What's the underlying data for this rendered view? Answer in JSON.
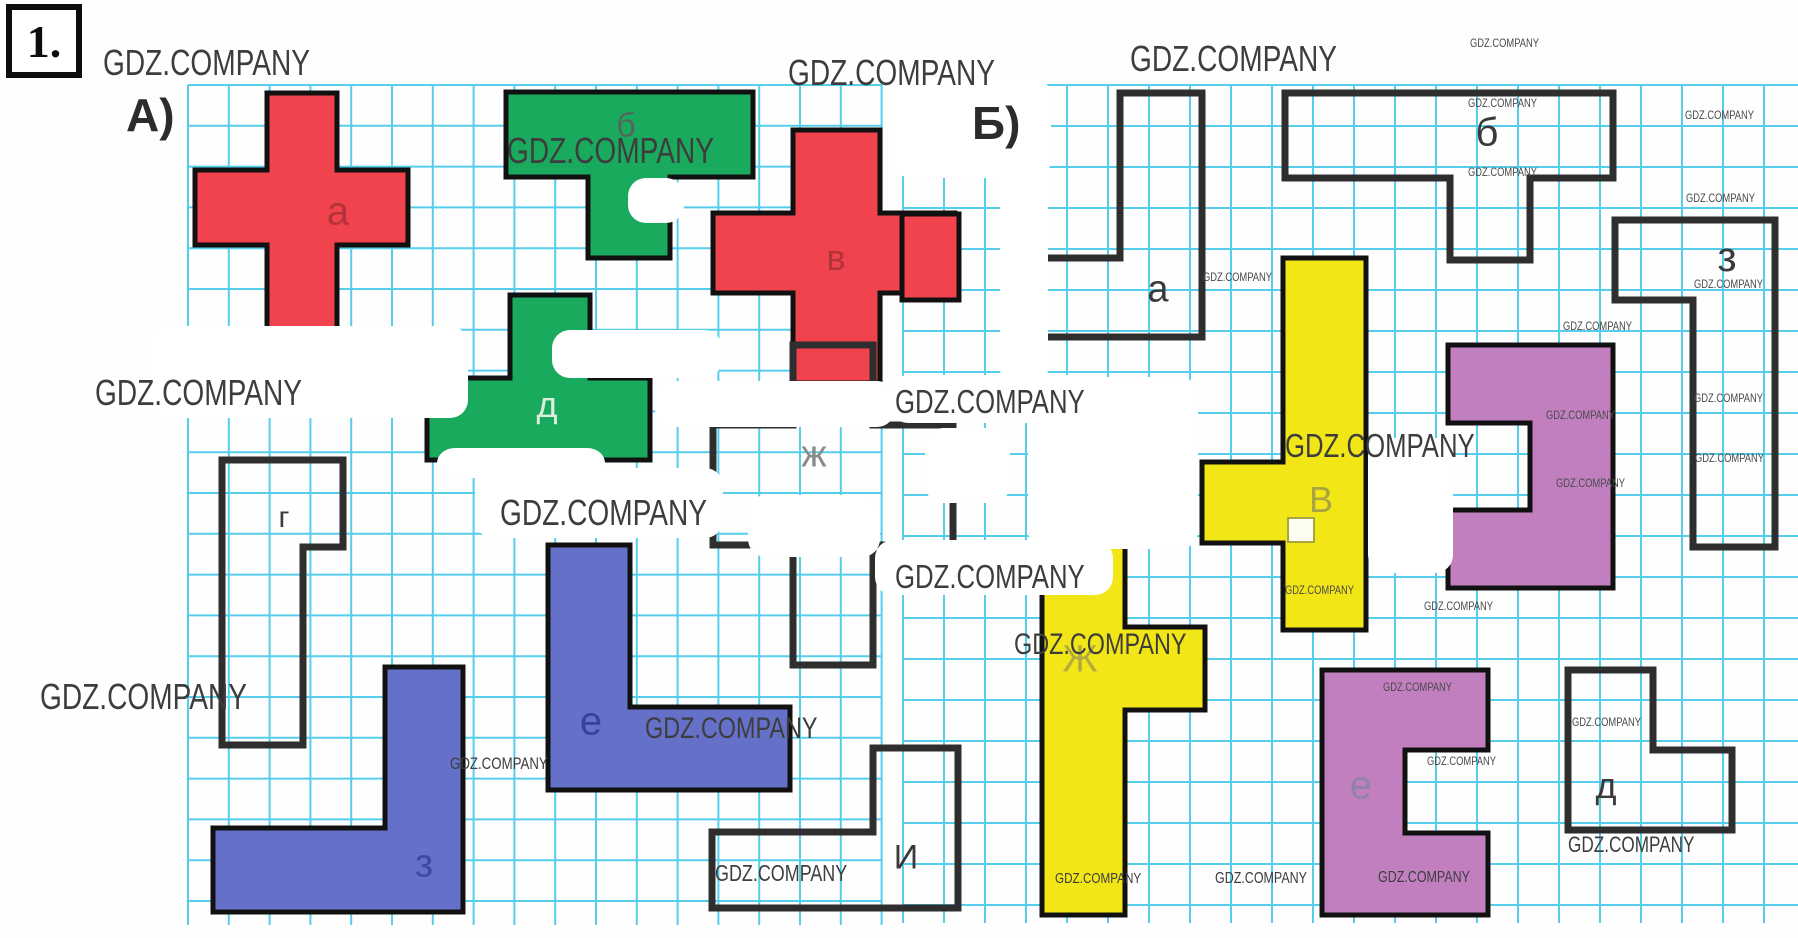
{
  "task_number": "1.",
  "watermark_text": "GDZ.COMPANY",
  "page": {
    "width": 1798,
    "height": 938,
    "background": "#fefefe"
  },
  "colors": {
    "grid": "#2cc3e8",
    "red": "#f0434e",
    "green": "#1aaa5d",
    "blue": "#6571c9",
    "yellow": "#f2e617",
    "purple": "#c27fc0",
    "outline": "#2e2e2e",
    "shape_border": "#111111"
  },
  "panels": [
    {
      "id": "A",
      "label": "А)",
      "label_x": 126,
      "label_y": 88,
      "grid": {
        "x": 188,
        "y": 85,
        "w": 694,
        "h": 840,
        "cell": 40.8
      }
    },
    {
      "id": "B",
      "label": "Б)",
      "label_x": 972,
      "label_y": 96,
      "grid": {
        "x": 903,
        "y": 85,
        "w": 895,
        "h": 838,
        "cell": 41
      }
    }
  ],
  "shapes": [
    {
      "id": "a-red-cross",
      "panel": "A",
      "fill": "#f0434e",
      "stroke": "#111111",
      "sw": 5,
      "points": [
        [
          267,
          93
        ],
        [
          337,
          93
        ],
        [
          337,
          170
        ],
        [
          408,
          170
        ],
        [
          408,
          245
        ],
        [
          337,
          245
        ],
        [
          337,
          330
        ],
        [
          267,
          330
        ],
        [
          267,
          245
        ],
        [
          195,
          245
        ],
        [
          195,
          170
        ],
        [
          267,
          170
        ]
      ],
      "label": "а",
      "lx": 338,
      "ly": 212,
      "lc": "#b3333b",
      "ls": 40
    },
    {
      "id": "b-green-tee",
      "panel": "A",
      "fill": "#1aaa5d",
      "stroke": "#111111",
      "sw": 5,
      "points": [
        [
          506,
          92
        ],
        [
          753,
          92
        ],
        [
          753,
          177
        ],
        [
          670,
          177
        ],
        [
          670,
          258
        ],
        [
          588,
          258
        ],
        [
          588,
          177
        ],
        [
          506,
          177
        ]
      ],
      "label": "б",
      "lx": 626,
      "ly": 126,
      "lc": "#51675a",
      "ls": 34
    },
    {
      "id": "v-red-cross",
      "panel": "A",
      "fill": "#f0434e",
      "stroke": "#111111",
      "sw": 5,
      "points": [
        [
          793,
          130
        ],
        [
          880,
          130
        ],
        [
          880,
          213
        ],
        [
          955,
          213
        ],
        [
          955,
          293
        ],
        [
          880,
          293
        ],
        [
          880,
          383
        ],
        [
          793,
          383
        ],
        [
          793,
          293
        ],
        [
          713,
          293
        ],
        [
          713,
          213
        ],
        [
          793,
          213
        ]
      ],
      "label": "в",
      "lx": 836,
      "ly": 258,
      "lc": "#b3333b",
      "ls": 36
    },
    {
      "id": "d-green-tee",
      "panel": "A",
      "fill": "#1aaa5d",
      "stroke": "#111111",
      "sw": 5,
      "points": [
        [
          510,
          295
        ],
        [
          590,
          295
        ],
        [
          590,
          378
        ],
        [
          650,
          378
        ],
        [
          650,
          460
        ],
        [
          427,
          460
        ],
        [
          427,
          378
        ],
        [
          510,
          378
        ]
      ],
      "label": "д",
      "lx": 547,
      "ly": 405,
      "lc": "#ddeede",
      "ls": 36
    },
    {
      "id": "g-outline",
      "panel": "A",
      "fill": "none",
      "stroke": "#2e2e2e",
      "sw": 7,
      "points": [
        [
          222,
          460
        ],
        [
          343,
          460
        ],
        [
          343,
          547
        ],
        [
          303,
          547
        ],
        [
          303,
          745
        ],
        [
          222,
          745
        ]
      ],
      "label": "г",
      "lx": 284,
      "ly": 518,
      "lc": "#3c3c3c",
      "ls": 30
    },
    {
      "id": "zh-outline",
      "panel": "A",
      "fill": "none",
      "stroke": "#2e2e2e",
      "sw": 7,
      "points": [
        [
          793,
          345
        ],
        [
          873,
          345
        ],
        [
          873,
          425
        ],
        [
          953,
          425
        ],
        [
          953,
          545
        ],
        [
          873,
          545
        ],
        [
          873,
          665
        ],
        [
          793,
          665
        ],
        [
          793,
          545
        ],
        [
          713,
          545
        ],
        [
          713,
          425
        ],
        [
          793,
          425
        ]
      ],
      "label": "ж",
      "lx": 814,
      "ly": 455,
      "lc": "#8a8a8a",
      "ls": 38
    },
    {
      "id": "e-blue-ell",
      "panel": "A",
      "fill": "#6571c9",
      "stroke": "#111111",
      "sw": 5,
      "points": [
        [
          548,
          545
        ],
        [
          630,
          545
        ],
        [
          630,
          707
        ],
        [
          790,
          707
        ],
        [
          790,
          790
        ],
        [
          548,
          790
        ]
      ],
      "label": "е",
      "lx": 591,
      "ly": 722,
      "lc": "#38429b",
      "ls": 40
    },
    {
      "id": "z-blue-ell",
      "panel": "A",
      "fill": "#6571c9",
      "stroke": "#111111",
      "sw": 5,
      "points": [
        [
          385,
          667
        ],
        [
          463,
          667
        ],
        [
          463,
          912
        ],
        [
          213,
          912
        ],
        [
          213,
          828
        ],
        [
          385,
          828
        ]
      ],
      "label": "з",
      "lx": 424,
      "ly": 864,
      "lc": "#3d4aa4",
      "ls": 40
    },
    {
      "id": "i-outline",
      "panel": "A",
      "fill": "none",
      "stroke": "#2e2e2e",
      "sw": 7,
      "points": [
        [
          712,
          832
        ],
        [
          873,
          832
        ],
        [
          873,
          748
        ],
        [
          958,
          748
        ],
        [
          958,
          908
        ],
        [
          712,
          908
        ]
      ],
      "label": "И",
      "lx": 906,
      "ly": 858,
      "lc": "#3a3a3a",
      "ls": 34
    },
    {
      "id": "red-square",
      "panel": "B",
      "fill": "#f0434e",
      "stroke": "#111111",
      "sw": 5,
      "points": [
        [
          902,
          214
        ],
        [
          959,
          214
        ],
        [
          959,
          300
        ],
        [
          902,
          300
        ]
      ],
      "label": "",
      "lx": 0,
      "ly": 0,
      "lc": "#000",
      "ls": 0
    },
    {
      "id": "a-outline-b",
      "panel": "B",
      "fill": "none",
      "stroke": "#2e2e2e",
      "sw": 7,
      "points": [
        [
          1120,
          93
        ],
        [
          1202,
          93
        ],
        [
          1202,
          337
        ],
        [
          1043,
          337
        ],
        [
          1043,
          258
        ],
        [
          1120,
          258
        ]
      ],
      "label": "а",
      "lx": 1158,
      "ly": 290,
      "lc": "#3a3a3a",
      "ls": 38
    },
    {
      "id": "b-outline-b",
      "panel": "B",
      "fill": "none",
      "stroke": "#2e2e2e",
      "sw": 7,
      "points": [
        [
          1285,
          93
        ],
        [
          1613,
          93
        ],
        [
          1613,
          178
        ],
        [
          1530,
          178
        ],
        [
          1530,
          260
        ],
        [
          1450,
          260
        ],
        [
          1450,
          178
        ],
        [
          1285,
          178
        ]
      ],
      "label": "б",
      "lx": 1487,
      "ly": 133,
      "lc": "#3a3a3a",
      "ls": 40
    },
    {
      "id": "v-yellow",
      "panel": "B",
      "fill": "#f2e617",
      "stroke": "#111111",
      "sw": 5,
      "points": [
        [
          1283,
          258
        ],
        [
          1366,
          258
        ],
        [
          1366,
          630
        ],
        [
          1283,
          630
        ],
        [
          1283,
          543
        ],
        [
          1202,
          543
        ],
        [
          1202,
          462
        ],
        [
          1283,
          462
        ]
      ],
      "label": "В",
      "lx": 1321,
      "ly": 500,
      "lc": "#a9a342",
      "ls": 36
    },
    {
      "id": "g-purple",
      "panel": "B",
      "fill": "#c27fc0",
      "stroke": "#111111",
      "sw": 5,
      "points": [
        [
          1448,
          345
        ],
        [
          1613,
          345
        ],
        [
          1613,
          588
        ],
        [
          1448,
          588
        ],
        [
          1448,
          510
        ],
        [
          1530,
          510
        ],
        [
          1530,
          423
        ],
        [
          1448,
          423
        ]
      ],
      "label": "",
      "lx": 0,
      "ly": 0,
      "lc": "#000",
      "ls": 0
    },
    {
      "id": "zh-yellow",
      "panel": "B",
      "fill": "#f2e617",
      "stroke": "#111111",
      "sw": 5,
      "points": [
        [
          1042,
          543
        ],
        [
          1125,
          543
        ],
        [
          1125,
          627
        ],
        [
          1205,
          627
        ],
        [
          1205,
          710
        ],
        [
          1125,
          710
        ],
        [
          1125,
          915
        ],
        [
          1042,
          915
        ]
      ],
      "label": "Ж",
      "lx": 1080,
      "ly": 660,
      "lc": "#b1ab3f",
      "ls": 38
    },
    {
      "id": "e-purple",
      "panel": "B",
      "fill": "#c27fc0",
      "stroke": "#111111",
      "sw": 5,
      "points": [
        [
          1322,
          670
        ],
        [
          1488,
          670
        ],
        [
          1488,
          750
        ],
        [
          1405,
          750
        ],
        [
          1405,
          833
        ],
        [
          1488,
          833
        ],
        [
          1488,
          915
        ],
        [
          1322,
          915
        ]
      ],
      "label": "е",
      "lx": 1361,
      "ly": 786,
      "lc": "#8f84a8",
      "ls": 40
    },
    {
      "id": "d-outline-b",
      "panel": "B",
      "fill": "none",
      "stroke": "#2e2e2e",
      "sw": 7,
      "points": [
        [
          1568,
          670
        ],
        [
          1653,
          670
        ],
        [
          1653,
          750
        ],
        [
          1732,
          750
        ],
        [
          1732,
          830
        ],
        [
          1568,
          830
        ]
      ],
      "label": "д",
      "lx": 1606,
      "ly": 786,
      "lc": "#3a3a3a",
      "ls": 36
    },
    {
      "id": "z-outline-b",
      "panel": "B",
      "fill": "none",
      "stroke": "#2e2e2e",
      "sw": 7,
      "points": [
        [
          1615,
          220
        ],
        [
          1775,
          220
        ],
        [
          1775,
          547
        ],
        [
          1693,
          547
        ],
        [
          1693,
          300
        ],
        [
          1615,
          300
        ]
      ],
      "label": "з",
      "lx": 1727,
      "ly": 257,
      "lc": "#3a3a3a",
      "ls": 42
    }
  ],
  "label_box": {
    "x": 1288,
    "y": 518,
    "w": 26,
    "h": 24,
    "fill": "#fdfdf2",
    "stroke": "#a7a642"
  },
  "whiteouts": [
    [
      148,
      326,
      320,
      92
    ],
    [
      552,
      330,
      170,
      48
    ],
    [
      655,
      381,
      240,
      46
    ],
    [
      748,
      495,
      132,
      62
    ],
    [
      925,
      428,
      85,
      75
    ],
    [
      890,
      375,
      225,
      48
    ],
    [
      875,
      540,
      238,
      55
    ],
    [
      1000,
      82,
      48,
      305
    ],
    [
      893,
      78,
      158,
      100
    ],
    [
      1028,
      377,
      170,
      172
    ],
    [
      475,
      468,
      248,
      70
    ],
    [
      437,
      448,
      168,
      30
    ],
    [
      628,
      178,
      56,
      45
    ],
    [
      1368,
      438,
      85,
      135
    ]
  ],
  "watermarks": [
    {
      "x": 103,
      "y": 42,
      "fs": 36
    },
    {
      "x": 788,
      "y": 52,
      "fs": 36
    },
    {
      "x": 1130,
      "y": 38,
      "fs": 36
    },
    {
      "x": 507,
      "y": 130,
      "fs": 36
    },
    {
      "x": 95,
      "y": 372,
      "fs": 36
    },
    {
      "x": 500,
      "y": 492,
      "fs": 36
    },
    {
      "x": 40,
      "y": 676,
      "fs": 36
    },
    {
      "x": 895,
      "y": 383,
      "fs": 33
    },
    {
      "x": 895,
      "y": 558,
      "fs": 33
    },
    {
      "x": 1285,
      "y": 427,
      "fs": 33
    },
    {
      "x": 1014,
      "y": 628,
      "fs": 30
    },
    {
      "x": 645,
      "y": 712,
      "fs": 30
    },
    {
      "x": 715,
      "y": 860,
      "fs": 23
    },
    {
      "x": 1568,
      "y": 832,
      "fs": 22
    },
    {
      "x": 450,
      "y": 754,
      "fs": 17
    },
    {
      "x": 1055,
      "y": 870,
      "fs": 15
    },
    {
      "x": 1215,
      "y": 870,
      "fs": 16
    },
    {
      "x": 1378,
      "y": 869,
      "fs": 16
    },
    {
      "x": 1470,
      "y": 36,
      "fs": 12
    },
    {
      "x": 1468,
      "y": 96,
      "fs": 12
    },
    {
      "x": 1468,
      "y": 165,
      "fs": 12
    },
    {
      "x": 1685,
      "y": 108,
      "fs": 12
    },
    {
      "x": 1686,
      "y": 191,
      "fs": 12
    },
    {
      "x": 1694,
      "y": 277,
      "fs": 12
    },
    {
      "x": 1563,
      "y": 319,
      "fs": 12
    },
    {
      "x": 1546,
      "y": 408,
      "fs": 12
    },
    {
      "x": 1694,
      "y": 391,
      "fs": 12
    },
    {
      "x": 1695,
      "y": 451,
      "fs": 12
    },
    {
      "x": 1556,
      "y": 476,
      "fs": 12
    },
    {
      "x": 1572,
      "y": 715,
      "fs": 12
    },
    {
      "x": 1203,
      "y": 270,
      "fs": 12
    },
    {
      "x": 1424,
      "y": 599,
      "fs": 12
    },
    {
      "x": 1383,
      "y": 680,
      "fs": 12
    },
    {
      "x": 1427,
      "y": 754,
      "fs": 12
    },
    {
      "x": 1285,
      "y": 583,
      "fs": 12
    }
  ]
}
